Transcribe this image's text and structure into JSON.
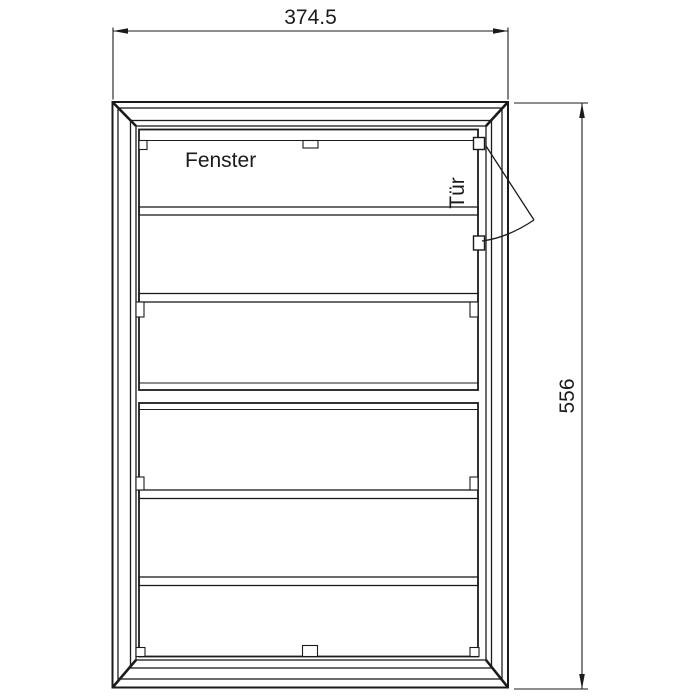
{
  "labels": {
    "window": "Fenster",
    "door": "Tür"
  },
  "dimensions": {
    "width": "374.5",
    "height": "556"
  },
  "colors": {
    "line": "#1b1b1b",
    "background": "#ffffff"
  }
}
